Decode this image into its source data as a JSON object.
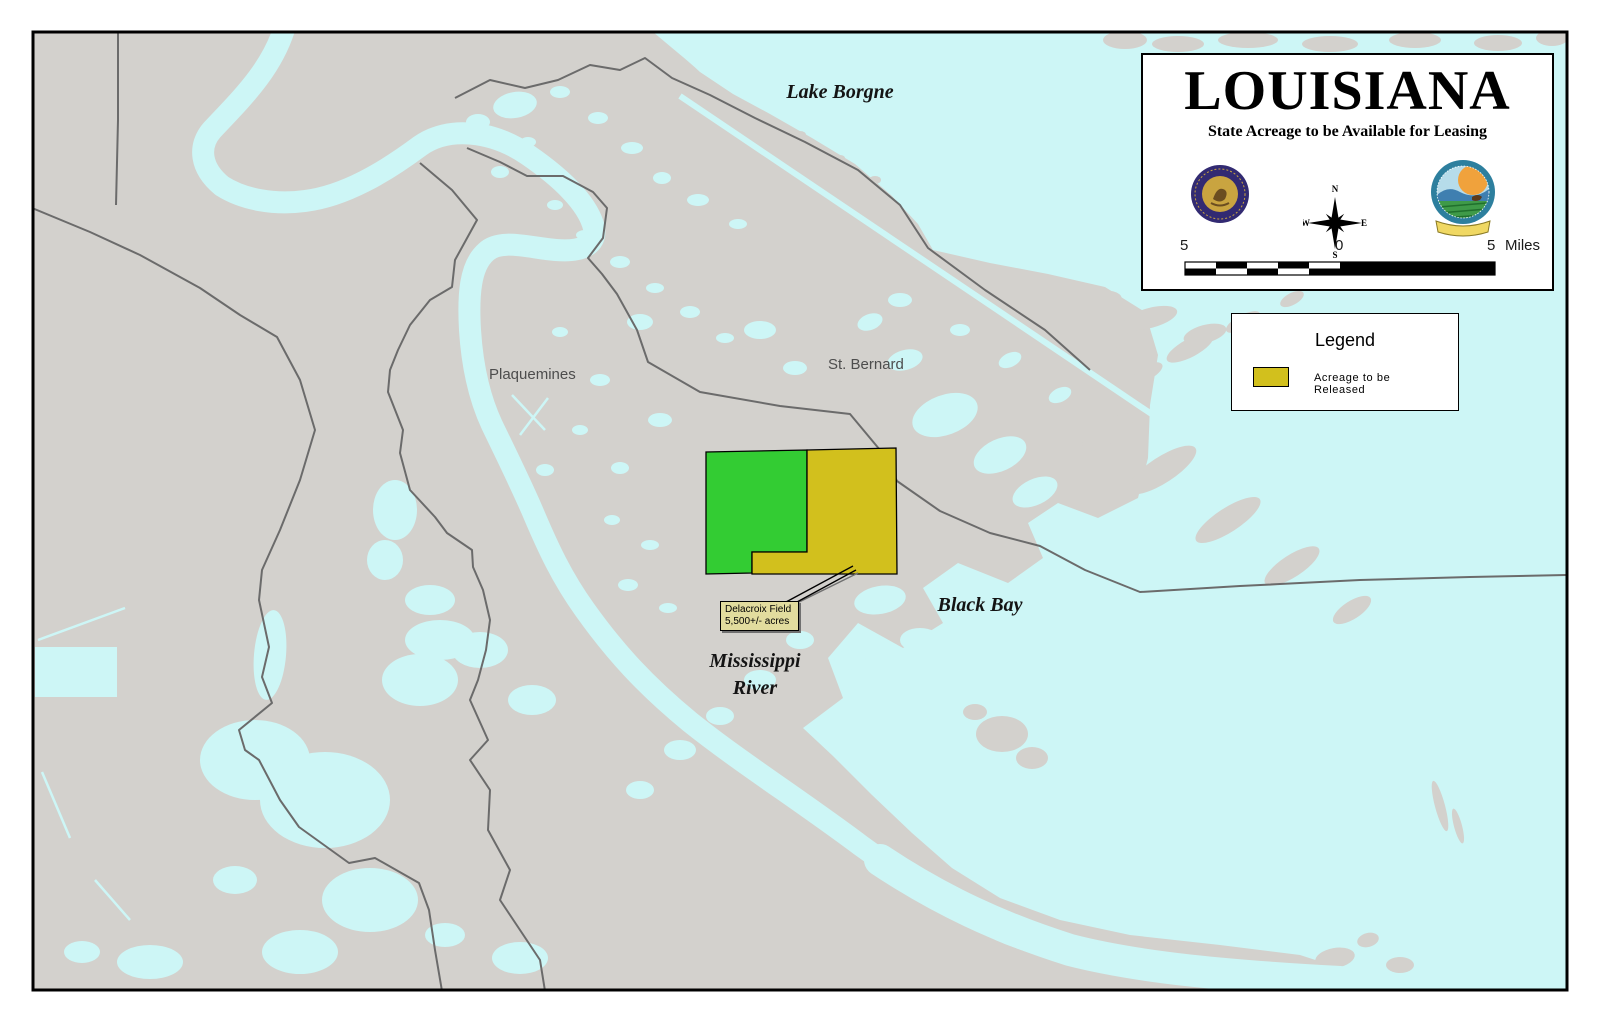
{
  "map": {
    "labels": {
      "lake": "Lake Borgne",
      "parish_west": "Plaquemines",
      "parish_east": "St. Bernard",
      "bay": "Black Bay",
      "river_line1": "Mississippi",
      "river_line2": "River"
    },
    "callout": {
      "line1": "Delacroix Field",
      "line2": "5,500+/- acres"
    },
    "colors": {
      "water": "#cdf6f6",
      "land": "#d3d1cd",
      "boundary": "#6b6b6b",
      "release_green": "#33cc33",
      "release_yellow": "#d2c01d",
      "callout_fill": "#e2dc9e",
      "frame": "#000000"
    }
  },
  "title_box": {
    "title": "LOUISIANA",
    "subtitle": "State Acreage to be Available for Leasing",
    "compass": {
      "n": "N",
      "s": "S",
      "e": "E",
      "w": "W"
    },
    "scale_bar": {
      "left_label": "5",
      "center_label": "0",
      "right_label": "5",
      "unit": "Miles"
    }
  },
  "legend": {
    "title": "Legend",
    "items": [
      {
        "label": "Acreage to be Released",
        "swatch_color": "#d2c01d"
      }
    ]
  }
}
